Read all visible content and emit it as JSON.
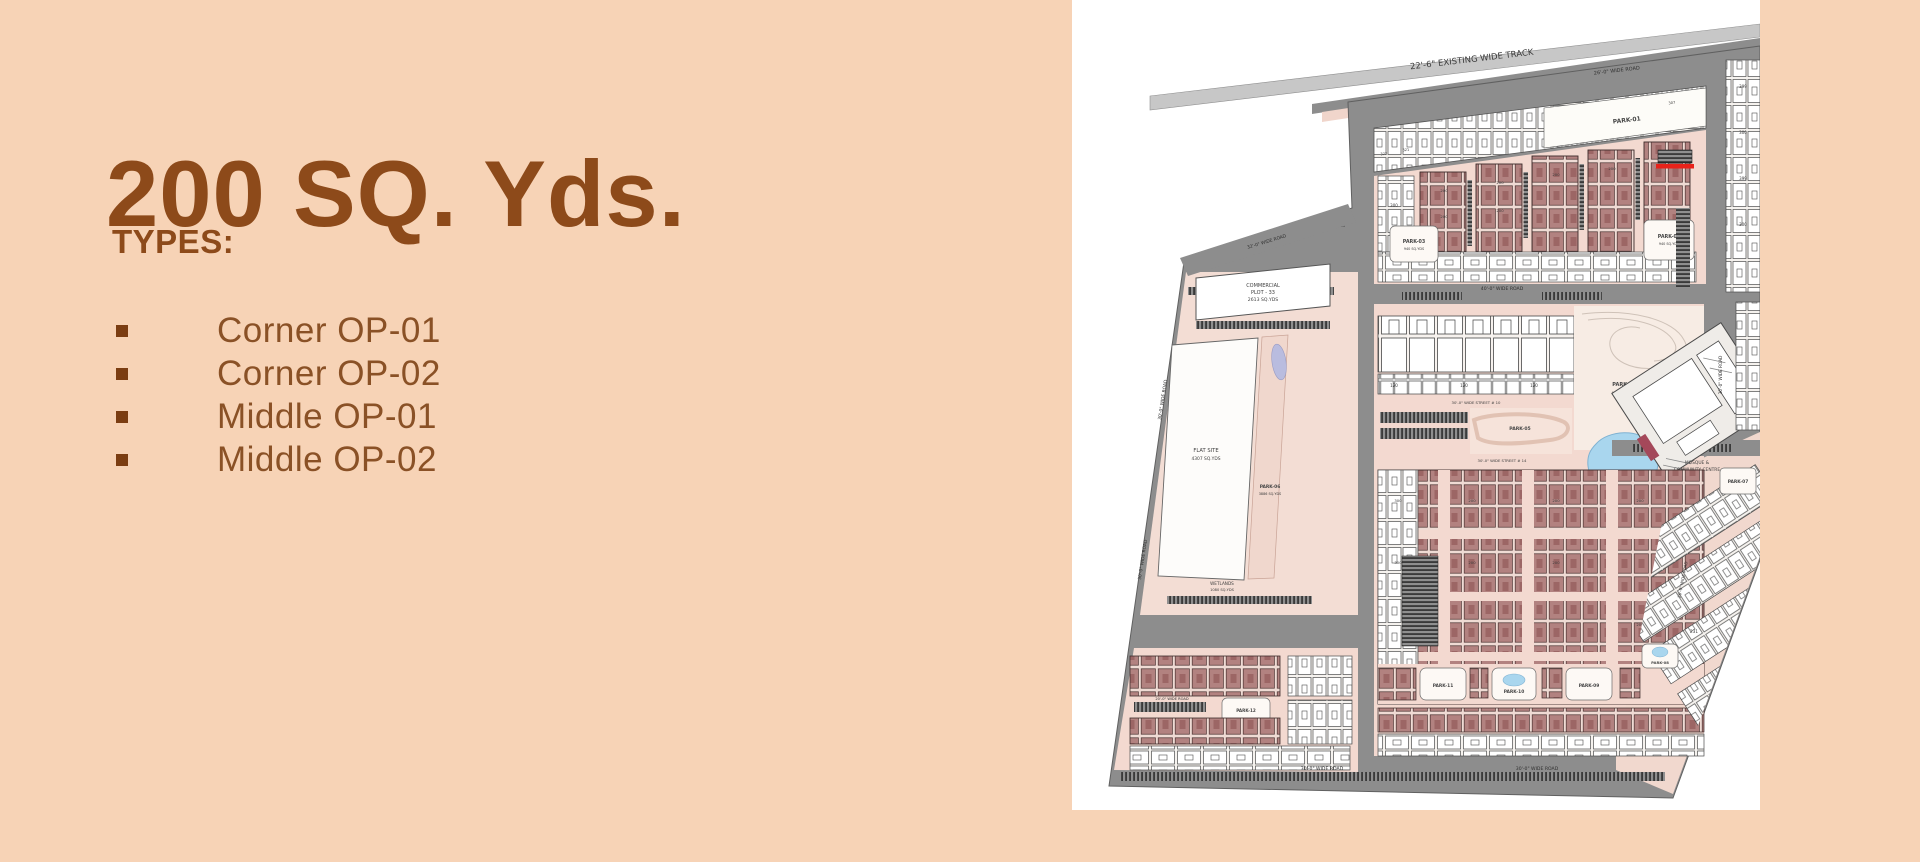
{
  "slide": {
    "title": "200 SQ. Yds.",
    "subtitle": "TYPES:",
    "bullets": [
      "Corner OP-01",
      "Corner OP-02",
      "Middle OP-01",
      "Middle OP-02"
    ],
    "colors": {
      "background": "#f7d3b6",
      "title_text": "#8d4a1a",
      "bullet_text": "#8a5126",
      "bullet_marker": "#7b3d12"
    }
  },
  "map": {
    "description": "Master site plan of 200 sq yd plots",
    "colors": {
      "plot_red": "#b28280",
      "street_pink": "#f3d9d0",
      "road_gray": "#8d8d8d",
      "track_gray": "#c7c7c7",
      "water_blue": "#a9d6ee",
      "gate_red": "#e8221a"
    },
    "labels": {
      "track": "22'-6\" EXISTING WIDE TRACK",
      "road_26": "26'-0\" WIDE ROAD",
      "road_26_diag": "26'-0\" WIDE ROAD",
      "road_32": "32'-0\" WIDE ROAD",
      "road_40": "40'-0\" WIDE ROAD",
      "road_30_left": "30'-0\" WIDE ROAD",
      "road_30_left2": "30'-0\" WIDE ROAD",
      "road_30_bottom1": "30'-0\" WIDE ROAD",
      "road_30_bottom2": "30'-0\" WIDE ROAD",
      "road_30_right": "30'-0\" WIDE ROAD",
      "road_20": "20'-0\" WIDE ROAD",
      "street_10": "30'-0\" WIDE STREET # 10",
      "street_14": "30'-0\" WIDE STREET # 14",
      "green_area": "GREEN AREA",
      "park_01": "PARK-01",
      "park_02": "PARK-02",
      "park_02_area": "940 SQ.YDS",
      "park_03": "PARK-03",
      "park_03_area": "940 SQ.YDS",
      "park_04": "PARK-04",
      "park_04_area": "4021 SQ.YDS",
      "park_05": "PARK-05",
      "park_06": "PARK-06",
      "park_06_area": "3886 SQ.YDS",
      "park_07": "PARK-07",
      "park_08": "PARK-08",
      "park_09": "PARK-09",
      "park_10": "PARK-10",
      "park_11": "PARK-11",
      "park_12": "PARK-12",
      "commercial_1": "COMMERCIAL",
      "commercial_2": "PLOT - 33",
      "commercial_3": "2613 SQ.YDS",
      "flat_site_1": "FLAT SITE",
      "flat_site_2": "4307 SQ.YDS",
      "wetlands_1": "WETLANDS",
      "wetlands_2": "1080 SQ.YDS",
      "mosque_1": "MOSQUE &",
      "mosque_2": "COMMUNITY CENTRE"
    },
    "plot_numbers": {
      "n200": "200",
      "n300": "300",
      "n120": "120",
      "n399": "399",
      "n322": "322",
      "n321": "321",
      "n307": "307",
      "n231": "231"
    }
  }
}
